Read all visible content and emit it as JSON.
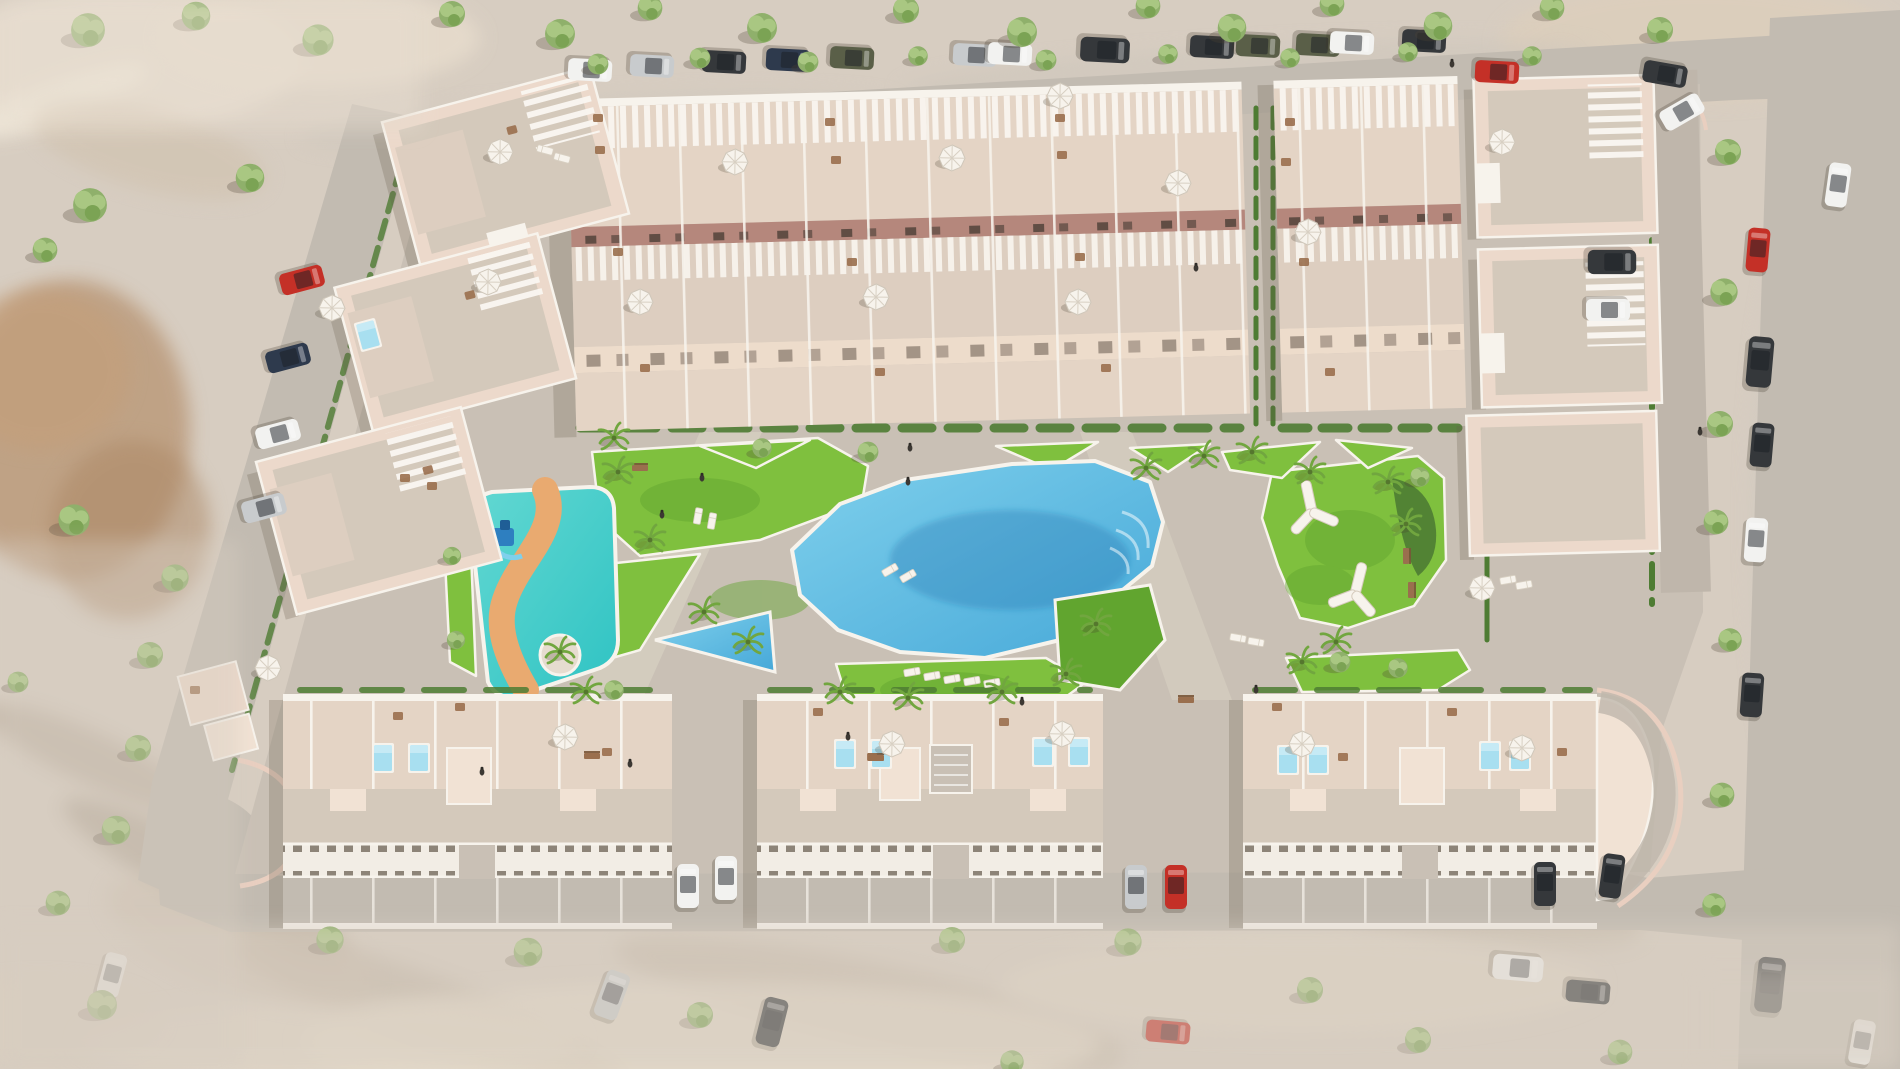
{
  "meta": {
    "description": "Aerial 3D architectural rendering of a residential complex with a central lagoon pool, children's splash park with winding slide river, landscaped gardens, rows of townhouses and villas with roof terraces, and surrounding streets with parked cars and trees"
  },
  "colors": {
    "sand": "#d7cdc1",
    "sandLight": "#e6dccf",
    "road": "#c2bbb1",
    "cobble": "#c9c0b5",
    "cobbleDark": "#bfb6ab",
    "curb": "#e9cfc0",
    "white": "#f7f3ec",
    "wall": "#ecd9cb",
    "wallLight": "#f1e2d4",
    "roof": "#d4c9bb",
    "terrace": "#e4d4c5",
    "terrace2": "#ddcec0",
    "facadeRed": "#b5877c",
    "facadeCream": "#eddccb",
    "band": "#f2ede5",
    "bandSlot": "#8d8478",
    "grass": "#7fc03e",
    "grassDark": "#61a52f",
    "hedge": "#4e7c33",
    "treeA": "#8fb06b",
    "treeB": "#a9c782",
    "treeC": "#7ba354",
    "palm": "#71a63f",
    "poolLight": "#7fd0ec",
    "poolDeep": "#46a8d8",
    "splashLight": "#63d8d2",
    "splashDeep": "#2fc3c3",
    "pathOrange": "#e9aa70",
    "miniPool": "#a8dff0",
    "wood": "#9a6f4e",
    "carWhite": "#f2f2f0",
    "carDark": "#35383b",
    "carSilver": "#c8cbcd",
    "carRed": "#c43027",
    "carArmy": "#5a5f48",
    "carNavy": "#2e3a4d"
  },
  "scene": {
    "blobs": [
      [
        120,
        60,
        180,
        70,
        0,
        "#e9dfd1",
        0.8
      ],
      [
        320,
        38,
        160,
        50,
        0,
        "#eadfcf",
        0.7
      ],
      [
        60,
        100,
        95,
        20,
        -20,
        "#f1e9da",
        0.9
      ],
      [
        150,
        150,
        120,
        40,
        15,
        "#cfc0ab",
        0.5
      ],
      [
        70,
        430,
        120,
        150,
        0,
        "#b5906d",
        0.7
      ],
      [
        40,
        370,
        90,
        80,
        0,
        "#c49e78",
        0.55
      ],
      [
        130,
        530,
        80,
        90,
        10,
        "#ab8663",
        0.5
      ],
      [
        205,
        878,
        160,
        30,
        28,
        "#9e917f",
        0.45
      ],
      [
        95,
        760,
        120,
        26,
        25,
        "#a89a88",
        0.4
      ],
      [
        430,
        1012,
        210,
        36,
        20,
        "#b3a694",
        0.45
      ],
      [
        870,
        1002,
        260,
        40,
        12,
        "#b7a996",
        0.4
      ],
      [
        1445,
        905,
        200,
        34,
        8,
        "#b6a895",
        0.35
      ],
      [
        700,
        1042,
        400,
        60,
        0,
        "#e8decd",
        0.7
      ],
      [
        1300,
        985,
        300,
        50,
        0,
        "#e4dac9",
        0.6
      ],
      [
        330,
        1040,
        250,
        40,
        0,
        "#e6dccb",
        0.6
      ],
      [
        1700,
        42,
        200,
        60,
        0,
        "#decfbb",
        0.7
      ],
      [
        1810,
        520,
        60,
        320,
        0,
        "#cfc8c0",
        0.5
      ],
      [
        600,
        122,
        300,
        26,
        -3,
        "#cdc6bc",
        0.5
      ],
      [
        1250,
        72,
        350,
        26,
        -3,
        "#ccc5bb",
        0.5
      ],
      [
        950,
        442,
        480,
        50,
        0,
        "#d3cabd",
        0.55
      ],
      [
        760,
        742,
        430,
        40,
        0,
        "#d1c8bb",
        0.5
      ],
      [
        1560,
        250,
        40,
        200,
        0,
        "#d8cdbf",
        0.5
      ],
      [
        240,
        940,
        140,
        50,
        20,
        "#cdbfae",
        0.5
      ],
      [
        40,
        1020,
        120,
        40,
        0,
        "#dccfbe",
        0.6
      ],
      [
        1880,
        900,
        60,
        120,
        0,
        "#c5beb5",
        0.5
      ]
    ],
    "trees": [
      [
        88,
        30,
        0,
        1.3
      ],
      [
        196,
        16,
        0,
        1.1
      ],
      [
        318,
        40,
        0,
        1.2
      ],
      [
        452,
        14,
        0,
        1.0
      ],
      [
        560,
        34,
        0,
        1.15
      ],
      [
        650,
        8,
        0,
        0.95
      ],
      [
        762,
        28,
        0,
        1.15
      ],
      [
        906,
        10,
        0,
        1.0
      ],
      [
        1022,
        32,
        0,
        1.15
      ],
      [
        1148,
        6,
        0,
        0.95
      ],
      [
        1232,
        28,
        0,
        1.1
      ],
      [
        1332,
        4,
        0,
        0.95
      ],
      [
        1438,
        26,
        0,
        1.1
      ],
      [
        1552,
        8,
        0,
        0.95
      ],
      [
        1660,
        30,
        0,
        1.0
      ],
      [
        598,
        64,
        0,
        0.8
      ],
      [
        700,
        58,
        0,
        0.8
      ],
      [
        808,
        62,
        0,
        0.8
      ],
      [
        918,
        56,
        0,
        0.75
      ],
      [
        1046,
        60,
        0,
        0.8
      ],
      [
        1168,
        54,
        0,
        0.75
      ],
      [
        1290,
        58,
        0,
        0.75
      ],
      [
        1408,
        52,
        0,
        0.75
      ],
      [
        1532,
        56,
        0,
        0.75
      ],
      [
        90,
        205,
        0,
        1.3
      ],
      [
        45,
        250,
        0,
        0.95
      ],
      [
        250,
        178,
        0,
        1.1
      ],
      [
        74,
        520,
        0,
        1.2
      ],
      [
        175,
        578,
        0,
        1.05
      ],
      [
        150,
        655,
        0,
        1.0
      ],
      [
        138,
        748,
        0,
        1.0
      ],
      [
        116,
        830,
        0,
        1.1
      ],
      [
        58,
        903,
        0,
        0.95
      ],
      [
        18,
        682,
        0,
        0.8
      ],
      [
        102,
        1005,
        0,
        1.15
      ],
      [
        330,
        940,
        0,
        1.05
      ],
      [
        528,
        952,
        0,
        1.1
      ],
      [
        700,
        1015,
        0,
        1.0
      ],
      [
        952,
        940,
        0,
        1.0
      ],
      [
        1128,
        942,
        0,
        1.05
      ],
      [
        1310,
        990,
        0,
        1.0
      ],
      [
        1418,
        1040,
        0,
        1.0
      ],
      [
        1620,
        1052,
        0,
        0.95
      ],
      [
        1012,
        1062,
        0,
        0.9
      ],
      [
        1728,
        152,
        0,
        1.0
      ],
      [
        1724,
        292,
        0,
        1.05
      ],
      [
        1720,
        424,
        0,
        1.0
      ],
      [
        1716,
        522,
        0,
        0.95
      ],
      [
        1730,
        640,
        0,
        0.9
      ],
      [
        1722,
        795,
        0,
        0.95
      ],
      [
        1714,
        905,
        0,
        0.9
      ],
      [
        868,
        452,
        0,
        0.8
      ],
      [
        762,
        448,
        0,
        0.75
      ],
      [
        1340,
        662,
        0,
        0.8
      ],
      [
        1398,
        668,
        0,
        0.75
      ],
      [
        614,
        690,
        0,
        0.75
      ],
      [
        1420,
        477,
        0,
        0.75
      ],
      [
        452,
        556,
        0,
        0.7
      ],
      [
        456,
        640,
        0,
        0.7
      ]
    ],
    "palms": [
      [
        618,
        472
      ],
      [
        650,
        540
      ],
      [
        704,
        612
      ],
      [
        748,
        642
      ],
      [
        840,
        692
      ],
      [
        908,
        698
      ],
      [
        1002,
        692
      ],
      [
        1066,
        674
      ],
      [
        1096,
        624
      ],
      [
        1146,
        468
      ],
      [
        1204,
        456
      ],
      [
        1252,
        452
      ],
      [
        1310,
        472
      ],
      [
        1388,
        482
      ],
      [
        1406,
        524
      ],
      [
        1336,
        642
      ],
      [
        1302,
        662
      ],
      [
        560,
        652
      ],
      [
        586,
        692
      ],
      [
        614,
        438
      ]
    ],
    "cars": [
      [
        590,
        70,
        93,
        1,
        "carWhite"
      ],
      [
        652,
        66,
        93,
        1,
        "carSilver"
      ],
      [
        724,
        62,
        93,
        1,
        "carDark"
      ],
      [
        788,
        60,
        93,
        1,
        "carNavy"
      ],
      [
        852,
        58,
        93,
        1,
        "carArmy"
      ],
      [
        975,
        55,
        93,
        1,
        "carSilver"
      ],
      [
        1010,
        54,
        93,
        1,
        "carWhite"
      ],
      [
        1105,
        50,
        93,
        1.12,
        "carDark"
      ],
      [
        1212,
        47,
        93,
        1,
        "carDark"
      ],
      [
        1258,
        46,
        93,
        1,
        "carArmy"
      ],
      [
        1318,
        45,
        93,
        1,
        "carArmy"
      ],
      [
        1352,
        43,
        93,
        1,
        "carWhite"
      ],
      [
        1424,
        41,
        93,
        1,
        "carDark"
      ],
      [
        1497,
        72,
        93,
        1,
        "carRed"
      ],
      [
        1665,
        74,
        100,
        1,
        "carDark"
      ],
      [
        1838,
        185,
        8,
        1,
        "carWhite"
      ],
      [
        1758,
        250,
        5,
        1,
        "carRed"
      ],
      [
        1760,
        362,
        5,
        1.15,
        "carDark"
      ],
      [
        1762,
        445,
        5,
        1,
        "carDark"
      ],
      [
        1756,
        540,
        4,
        1,
        "carWhite"
      ],
      [
        1752,
        695,
        4,
        1,
        "carDark"
      ],
      [
        1770,
        985,
        6,
        1.25,
        "carDark"
      ],
      [
        1862,
        1042,
        10,
        1,
        "carWhite"
      ],
      [
        302,
        280,
        75,
        1,
        "carRed"
      ],
      [
        288,
        358,
        75,
        1,
        "carNavy"
      ],
      [
        278,
        434,
        75,
        1,
        "carWhite"
      ],
      [
        264,
        508,
        75,
        1,
        "carSilver"
      ],
      [
        112,
        975,
        15,
        1,
        "carWhite"
      ],
      [
        612,
        995,
        20,
        1.1,
        "carSilver"
      ],
      [
        772,
        1022,
        14,
        1.1,
        "carDark"
      ],
      [
        1168,
        1032,
        95,
        1,
        "carRed"
      ],
      [
        1518,
        968,
        95,
        1.15,
        "carWhite"
      ],
      [
        1588,
        992,
        95,
        1,
        "carDark"
      ],
      [
        688,
        886,
        0,
        1,
        "carWhite"
      ],
      [
        726,
        878,
        0,
        1,
        "carWhite"
      ],
      [
        1136,
        887,
        0,
        1,
        "carSilver"
      ],
      [
        1176,
        887,
        0,
        1,
        "carRed"
      ],
      [
        1545,
        884,
        0,
        1,
        "carDark"
      ],
      [
        1612,
        876,
        8,
        1,
        "carDark"
      ],
      [
        1682,
        112,
        60,
        1,
        "carWhite"
      ],
      [
        1612,
        262,
        90,
        1.1,
        "carDark"
      ],
      [
        1608,
        310,
        90,
        1,
        "carWhite"
      ]
    ],
    "parasols": [
      [
        500,
        152,
        1
      ],
      [
        735,
        162,
        1
      ],
      [
        952,
        158,
        1
      ],
      [
        1178,
        183,
        1
      ],
      [
        488,
        282,
        1
      ],
      [
        640,
        302,
        1
      ],
      [
        876,
        297,
        1
      ],
      [
        1078,
        302,
        1
      ],
      [
        1308,
        232,
        1
      ],
      [
        1502,
        142,
        1
      ],
      [
        332,
        308,
        1
      ],
      [
        268,
        668,
        0.9
      ],
      [
        565,
        737,
        1
      ],
      [
        892,
        744,
        1
      ],
      [
        1062,
        734,
        1
      ],
      [
        1302,
        744,
        1
      ],
      [
        1522,
        748,
        1
      ],
      [
        1482,
        588,
        1
      ],
      [
        1060,
        96,
        0.8
      ]
    ],
    "minipools": [
      [
        383,
        758
      ],
      [
        419,
        758
      ],
      [
        845,
        754
      ],
      [
        881,
        754
      ],
      [
        1043,
        752
      ],
      [
        1079,
        752
      ],
      [
        1288,
        760
      ],
      [
        1318,
        760
      ],
      [
        1490,
        756
      ],
      [
        1520,
        756
      ],
      [
        368,
        335,
        -15
      ]
    ],
    "ypergolas": [
      [
        1312,
        512,
        -12
      ],
      [
        1355,
        594,
        14
      ]
    ],
    "loungers": [
      [
        912,
        672,
        80
      ],
      [
        932,
        676,
        80
      ],
      [
        952,
        679,
        80
      ],
      [
        972,
        681,
        80
      ],
      [
        992,
        683,
        80
      ],
      [
        698,
        516,
        10
      ],
      [
        712,
        521,
        10
      ],
      [
        545,
        150,
        -75
      ],
      [
        562,
        158,
        -75
      ],
      [
        1238,
        638,
        100
      ],
      [
        1256,
        642,
        100
      ],
      [
        1508,
        580,
        80
      ],
      [
        1524,
        585,
        80
      ],
      [
        890,
        570,
        60
      ],
      [
        908,
        576,
        60
      ]
    ],
    "benches": [
      [
        640,
        468,
        0
      ],
      [
        1406,
        556,
        90
      ],
      [
        1411,
        590,
        90
      ],
      [
        592,
        756,
        0
      ],
      [
        876,
        758,
        0
      ],
      [
        1186,
        700,
        0
      ]
    ],
    "people": [
      [
        662,
        515
      ],
      [
        702,
        478
      ],
      [
        908,
        482
      ],
      [
        1022,
        702
      ],
      [
        848,
        737
      ],
      [
        630,
        764
      ],
      [
        1196,
        268
      ],
      [
        1452,
        64
      ],
      [
        910,
        448
      ],
      [
        1700,
        432
      ],
      [
        482,
        772
      ],
      [
        1256,
        690
      ]
    ],
    "furniture": [
      [
        398,
        716
      ],
      [
        460,
        707
      ],
      [
        607,
        752
      ],
      [
        818,
        712
      ],
      [
        872,
        757
      ],
      [
        1004,
        722
      ],
      [
        1277,
        707
      ],
      [
        1343,
        757
      ],
      [
        1452,
        712
      ],
      [
        1562,
        752
      ],
      [
        598,
        118
      ],
      [
        830,
        122
      ],
      [
        1060,
        118
      ],
      [
        1290,
        122
      ],
      [
        600,
        150
      ],
      [
        836,
        160
      ],
      [
        1062,
        155
      ],
      [
        1286,
        162
      ],
      [
        618,
        252
      ],
      [
        852,
        262
      ],
      [
        1080,
        257
      ],
      [
        1304,
        262
      ],
      [
        645,
        368
      ],
      [
        880,
        372
      ],
      [
        1106,
        368
      ],
      [
        1330,
        372
      ],
      [
        512,
        130,
        -15
      ],
      [
        470,
        295,
        -15
      ],
      [
        428,
        470,
        -15
      ],
      [
        195,
        690
      ],
      [
        405,
        478
      ],
      [
        432,
        486
      ]
    ]
  }
}
